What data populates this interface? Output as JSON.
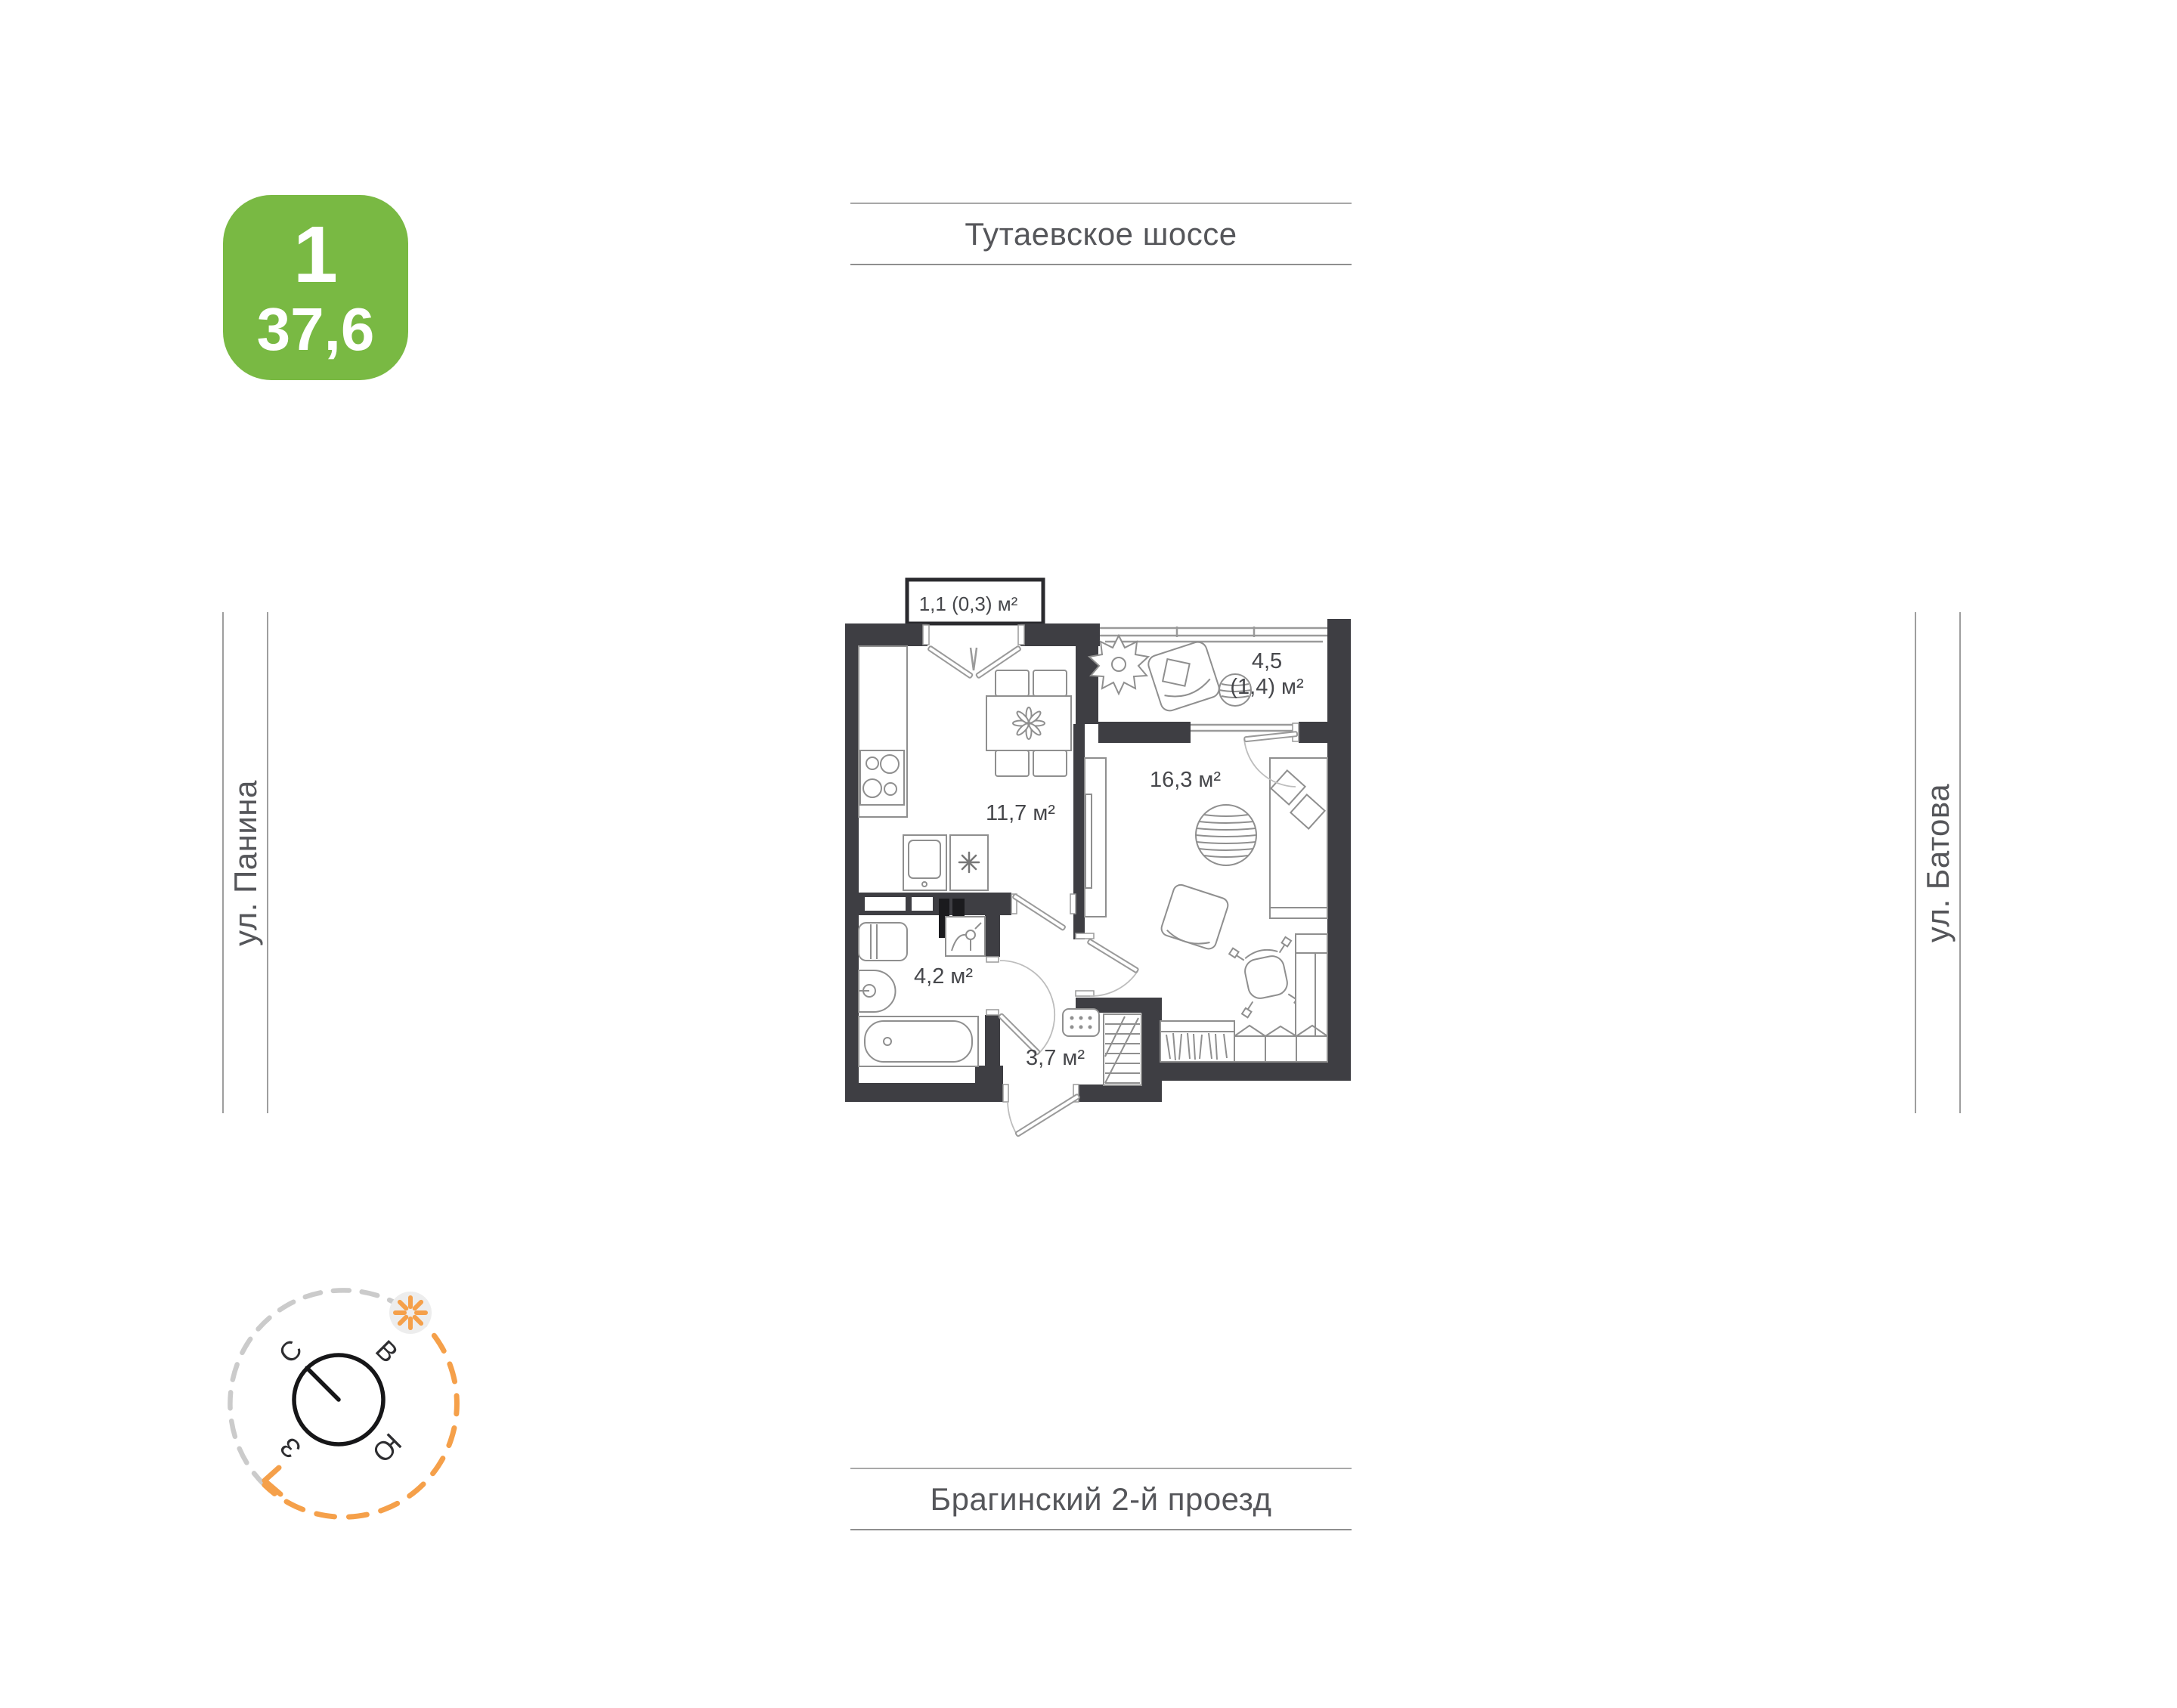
{
  "badge": {
    "rooms": "1",
    "area": "37,6"
  },
  "streets": {
    "top": "Тутаевское шоссе",
    "bottom": "Брагинский 2-й проезд",
    "left": "ул. Панина",
    "right": "ул. Батова"
  },
  "compass": {
    "north": "С",
    "east": "В",
    "south": "Ю",
    "west": "З"
  },
  "plan": {
    "labels": {
      "balcony": "1,1 (0,3) м²",
      "loggia_main": "4,5",
      "loggia_sub": "(1,4) м²",
      "kitchen": "11,7 м²",
      "living": "16,3 м²",
      "bathroom": "4,2 м²",
      "hallway": "3,7 м²"
    }
  },
  "colors": {
    "badge_green": "#79B943",
    "accent_orange": "#F5A04A",
    "wall_dark": "#3E3E43",
    "street_text": "#55565A"
  }
}
